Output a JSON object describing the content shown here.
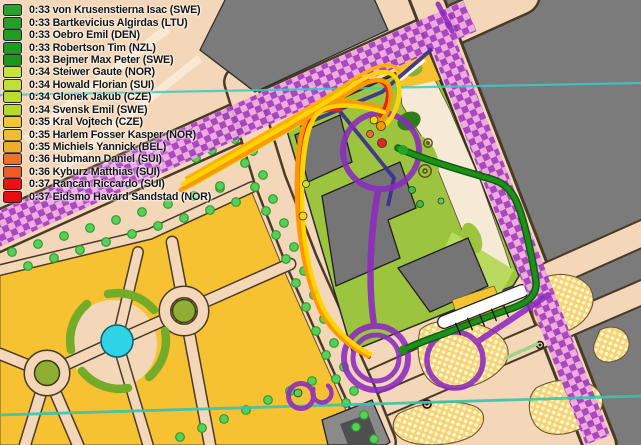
{
  "app": {
    "title": "Orienteering live GPS tracking map"
  },
  "legend": {
    "items": [
      {
        "time": "0:33",
        "runner": "von Krusenstierna Isac",
        "country": "SWE",
        "label": "0:33 von Krusenstierna Isac (SWE)",
        "color": "#27a327"
      },
      {
        "time": "0:33",
        "runner": "Bartkevicius Algirdas",
        "country": "LTU",
        "label": "0:33 Bartkevicius Algirdas (LTU)",
        "color": "#24a024"
      },
      {
        "time": "0:33",
        "runner": "Oebro Emil",
        "country": "DEN",
        "label": "0:33 Oebro Emil (DEN)",
        "color": "#219d21"
      },
      {
        "time": "0:33",
        "runner": "Robertson Tim",
        "country": "NZL",
        "label": "0:33 Robertson Tim (NZL)",
        "color": "#1e9a1e"
      },
      {
        "time": "0:33",
        "runner": "Bejmer Max Peter",
        "country": "SWE",
        "label": "0:33 Bejmer Max Peter (SWE)",
        "color": "#1b971b"
      },
      {
        "time": "0:34",
        "runner": "Steiwer Gaute",
        "country": "NOR",
        "label": "0:34 Steiwer Gaute (NOR)",
        "color": "#c8e23c"
      },
      {
        "time": "0:34",
        "runner": "Howald Florian",
        "country": "SUI",
        "label": "0:34 Howald Florian (SUI)",
        "color": "#c2df36"
      },
      {
        "time": "0:34",
        "runner": "Glonek Jakub",
        "country": "CZE",
        "label": "0:34 Glonek Jakub (CZE)",
        "color": "#bcdc30"
      },
      {
        "time": "0:34",
        "runner": "Svensk Emil",
        "country": "SWE",
        "label": "0:34 Svensk Emil (SWE)",
        "color": "#b6d92b"
      },
      {
        "time": "0:35",
        "runner": "Kral Vojtech",
        "country": "CZE",
        "label": "0:35 Kral Vojtech (CZE)",
        "color": "#f1c633"
      },
      {
        "time": "0:35",
        "runner": "Harlem Fosser Kasper",
        "country": "NOR",
        "label": "0:35 Harlem Fosser Kasper (NOR)",
        "color": "#f0bd2d"
      },
      {
        "time": "0:35",
        "runner": "Michiels Yannick",
        "country": "BEL",
        "label": "0:35 Michiels Yannick (BEL)",
        "color": "#efae27"
      },
      {
        "time": "0:36",
        "runner": "Hubmann Daniel",
        "country": "SUI",
        "label": "0:36 Hubmann Daniel (SUI)",
        "color": "#f07024"
      },
      {
        "time": "0:36",
        "runner": "Kyburz Matthias",
        "country": "SUI",
        "label": "0:36 Kyburz Matthias (SUI)",
        "color": "#ee5d20"
      },
      {
        "time": "0:37",
        "runner": "Rancan Riccardo",
        "country": "SUI",
        "label": "0:37 Rancan Riccardo (SUI)",
        "color": "#ec1212"
      },
      {
        "time": "0:37",
        "runner": "Eidsmo Havard Sandstad",
        "country": "NOR",
        "label": "0:37 Eidsmo Havard Sandstad (NOR)",
        "color": "#ea0f0f"
      }
    ]
  },
  "map": {
    "kind_label": "sprint orienteering map with course overprint and GPS tracks",
    "control_circle_count": 4,
    "teal_section_line_count": 2
  },
  "palette": {
    "street_peach": "#f3d7b8",
    "building_gray": "#7b7b7b",
    "park_green": "#9cc43f",
    "garden_yellow": "#f7c232",
    "dotted_yellow": "#f6d36e",
    "pond_cyan": "#2fd3e6",
    "course_purple": "#8c2abf",
    "forbidden_checker_purple": "#a838c4",
    "course_navy": "#3b2f92",
    "teal_line": "#3cc4ae",
    "track_yellow": "#ffd400",
    "track_orange": "#ff9800",
    "track_red": "#e62222",
    "track_chartreuse": "#c9e23a",
    "track_green": "#1f8f1c",
    "tree_dot_green": "#58cf58"
  }
}
